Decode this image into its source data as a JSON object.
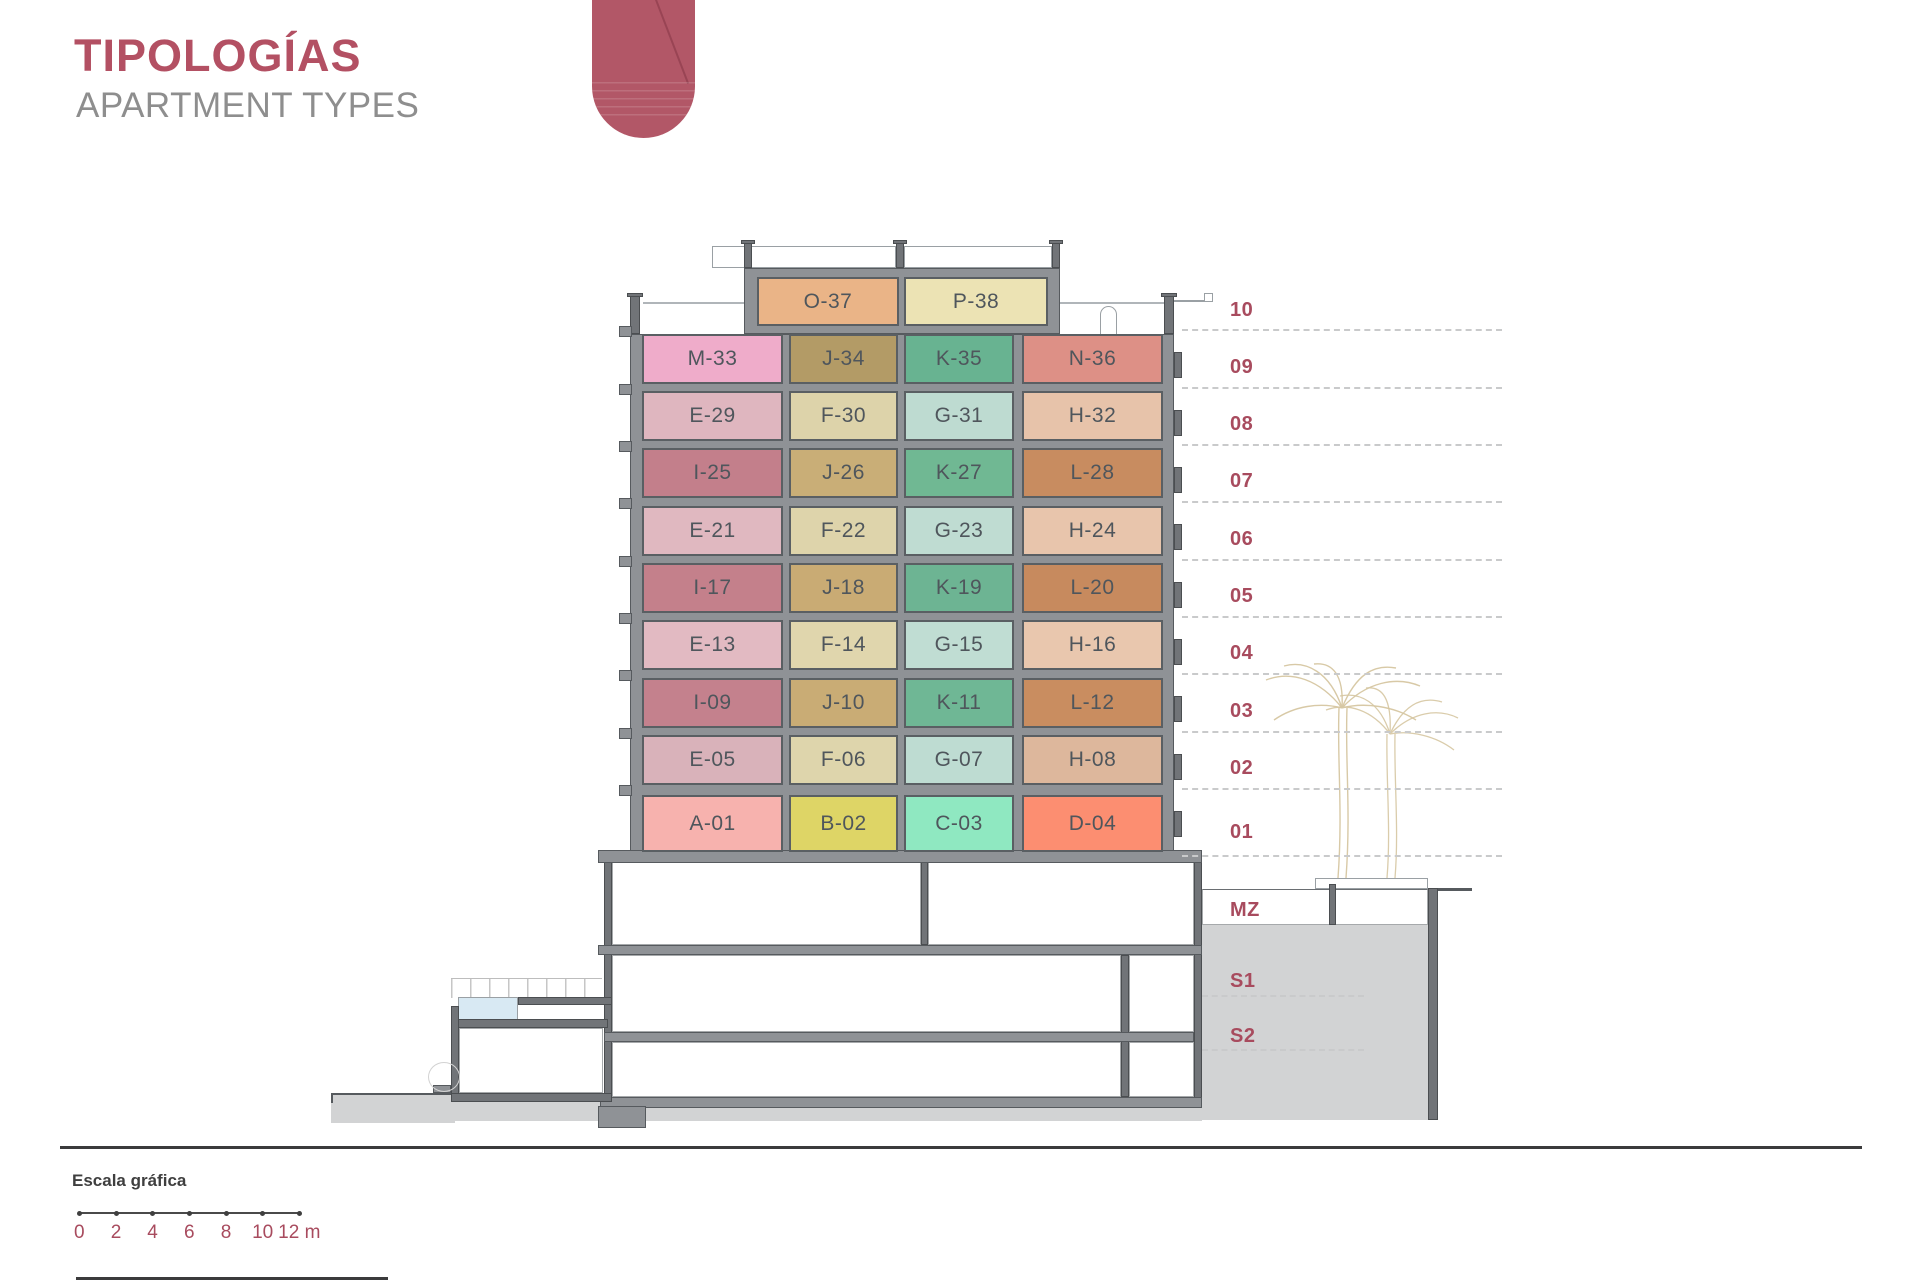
{
  "header": {
    "title": "TIPOLOGÍAS",
    "subtitle": "APARTMENT TYPES"
  },
  "colors": {
    "accent": "#a84b5e",
    "accent_title": "#b35063",
    "subtitle": "#8e8e8e",
    "ribbon": "#b25767",
    "wall": "#8f9296",
    "wall_dark": "#717478",
    "ground": "#d2d3d4",
    "pool": "#d8e9f3",
    "cell_text": "#4f565c"
  },
  "building": {
    "floors": [
      {
        "level": "10",
        "units": [
          {
            "id": "O-37",
            "color": "#eab487"
          },
          {
            "id": "P-38",
            "color": "#ece3b4"
          }
        ]
      },
      {
        "level": "09",
        "units": [
          {
            "id": "M-33",
            "color": "#efacca"
          },
          {
            "id": "J-34",
            "color": "#b39b66"
          },
          {
            "id": "K-35",
            "color": "#68b391"
          },
          {
            "id": "N-36",
            "color": "#dd9086"
          }
        ]
      },
      {
        "level": "08",
        "units": [
          {
            "id": "E-29",
            "color": "#dfb6bf"
          },
          {
            "id": "F-30",
            "color": "#ddd3aa"
          },
          {
            "id": "G-31",
            "color": "#bedbd1"
          },
          {
            "id": "H-32",
            "color": "#e7c3aa"
          }
        ]
      },
      {
        "level": "07",
        "units": [
          {
            "id": "I-25",
            "color": "#c37f8b"
          },
          {
            "id": "J-26",
            "color": "#c9ae77"
          },
          {
            "id": "K-27",
            "color": "#70b893"
          },
          {
            "id": "L-28",
            "color": "#c88c60"
          }
        ]
      },
      {
        "level": "06",
        "units": [
          {
            "id": "E-21",
            "color": "#e0b8c0"
          },
          {
            "id": "F-22",
            "color": "#ded4ab"
          },
          {
            "id": "G-23",
            "color": "#bfdcd2"
          },
          {
            "id": "H-24",
            "color": "#e8c5ac"
          }
        ]
      },
      {
        "level": "05",
        "units": [
          {
            "id": "I-17",
            "color": "#c4808b"
          },
          {
            "id": "J-18",
            "color": "#c9ab74"
          },
          {
            "id": "K-19",
            "color": "#6db493"
          },
          {
            "id": "L-20",
            "color": "#c78a5e"
          }
        ]
      },
      {
        "level": "04",
        "units": [
          {
            "id": "E-13",
            "color": "#e2bac2"
          },
          {
            "id": "F-14",
            "color": "#e0d6ad"
          },
          {
            "id": "G-15",
            "color": "#c0ddd3"
          },
          {
            "id": "H-16",
            "color": "#e9c7ae"
          }
        ]
      },
      {
        "level": "03",
        "units": [
          {
            "id": "I-09",
            "color": "#c4818d"
          },
          {
            "id": "J-10",
            "color": "#c9ac75"
          },
          {
            "id": "K-11",
            "color": "#6fb795"
          },
          {
            "id": "L-12",
            "color": "#c98d60"
          }
        ]
      },
      {
        "level": "02",
        "units": [
          {
            "id": "E-05",
            "color": "#d9b2ba"
          },
          {
            "id": "F-06",
            "color": "#ded5ac"
          },
          {
            "id": "G-07",
            "color": "#bedcd2"
          },
          {
            "id": "H-08",
            "color": "#ddb79c"
          }
        ]
      },
      {
        "level": "01",
        "units": [
          {
            "id": "A-01",
            "color": "#f7b2ae"
          },
          {
            "id": "B-02",
            "color": "#ded566"
          },
          {
            "id": "C-03",
            "color": "#8fe8c1"
          },
          {
            "id": "D-04",
            "color": "#fc8e71"
          }
        ]
      }
    ],
    "basement_levels": [
      {
        "label": "MZ"
      },
      {
        "label": "S1"
      },
      {
        "label": "S2"
      }
    ]
  },
  "scalebar": {
    "heading": "Escala gráfica",
    "ticks": [
      "0",
      "2",
      "4",
      "6",
      "8",
      "10",
      "12 m"
    ]
  }
}
